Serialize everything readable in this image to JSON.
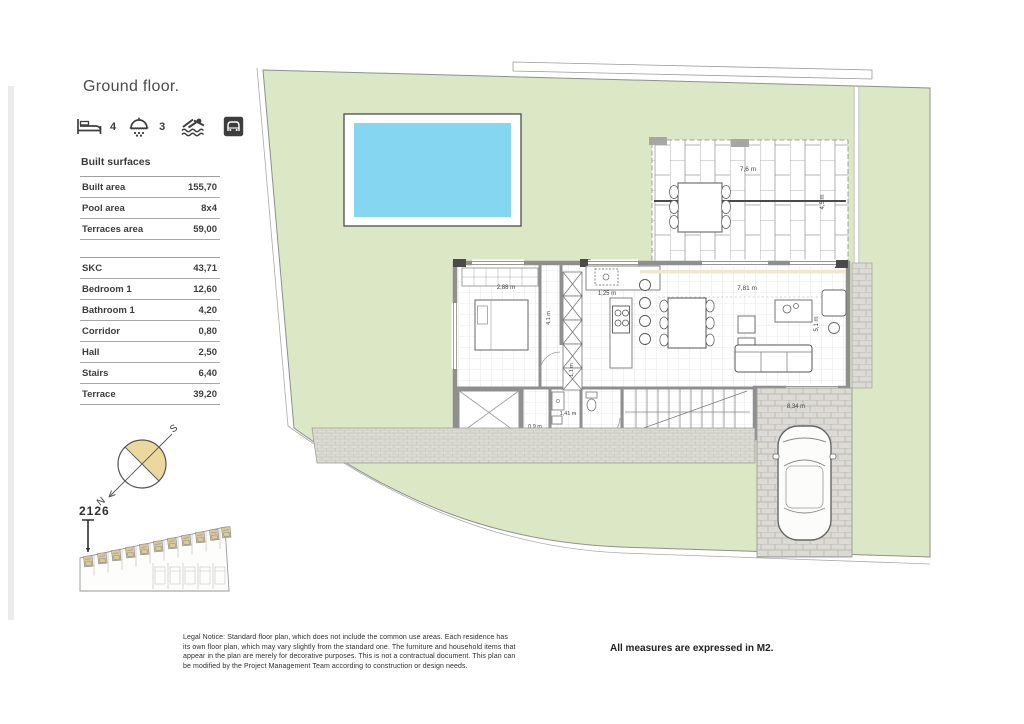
{
  "title": "Ground floor.",
  "amenities": {
    "bedrooms": "4",
    "bathrooms": "3"
  },
  "built_surfaces": {
    "heading": "Built surfaces",
    "group1": [
      {
        "label": "Built area",
        "value": "155,70"
      },
      {
        "label": "Pool area",
        "value": "8x4"
      },
      {
        "label": "Terraces area",
        "value": "59,00"
      }
    ],
    "group2": [
      {
        "label": "SKC",
        "value": "43,71"
      },
      {
        "label": "Bedroom 1",
        "value": "12,60"
      },
      {
        "label": "Bathroom 1",
        "value": "4,20"
      },
      {
        "label": "Corridor",
        "value": "0,80"
      },
      {
        "label": "Hall",
        "value": "2,50"
      },
      {
        "label": "Stairs",
        "value": "6,40"
      },
      {
        "label": "Terrace",
        "value": "39,20"
      }
    ]
  },
  "compass": {
    "north": "N",
    "south": "S"
  },
  "site_plan": {
    "unit_number": "2126"
  },
  "plan": {
    "dims": {
      "terrace_width": "7,6 m",
      "terrace_depth": "4,5 m",
      "bedroom_width": "2,88 m",
      "corridor_depth": "4,1 m",
      "kitchen_width": "1,25 m",
      "hall_width": "1,1 m",
      "living_width": "7,81 m",
      "living_depth": "5,1 m",
      "bath_width": "1,41 m",
      "patio_width": "0,9 m",
      "driveway_length": "8,34 m"
    }
  },
  "footer": {
    "legal_notice": "Legal Notice: Standard floor plan, which does not include the common use areas. Each residence has its own floor plan, which may vary slightly from the standard one. The furniture and household items that appear in the plan are merely for decorative purposes. This is not a contractual document. This plan can be modified by the Project Management Team according to construction or design needs.",
    "measures_note": "All measures are expressed in M2."
  },
  "colors": {
    "plot_green": "#dce7c5",
    "pool_blue": "#85d6f0",
    "accent_tan": "#ecd79f",
    "wall_grey": "#9a9a9a"
  }
}
